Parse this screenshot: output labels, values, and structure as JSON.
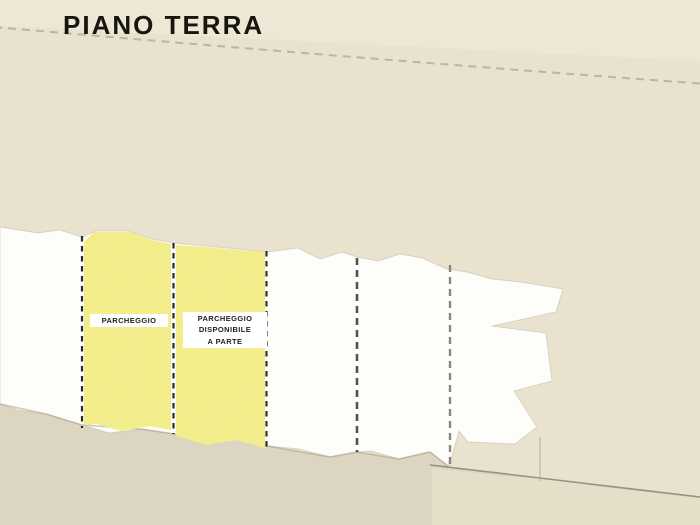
{
  "page": {
    "title": "PIANO TERRA"
  },
  "plan": {
    "floor_label": "PIANO TERRA",
    "spaces": [
      {
        "name": "space-1",
        "label": "",
        "highlighted": false
      },
      {
        "name": "space-2",
        "label": "PARCHEGGIO",
        "highlighted": true
      },
      {
        "name": "space-3",
        "label": "PARCHEGGIO\nDISPONIBILE\nA PARTE",
        "highlighted": true
      },
      {
        "name": "space-4",
        "label": "",
        "highlighted": false
      },
      {
        "name": "space-5",
        "label": "",
        "highlighted": false
      },
      {
        "name": "space-6",
        "label": "",
        "highlighted": false
      }
    ]
  },
  "colors": {
    "background": "#e9e2cf",
    "background_upper": "#eee8d6",
    "background_band": "#dcd5c1",
    "background_lower": "#e5dec9",
    "paper_white": "#fdfdfa",
    "highlight_yellow": "#f0ea7f",
    "highlight_dot": "#faf6ad",
    "divider_black": "#2e2b26",
    "divider_dark_gray": "#55524b",
    "divider_light_gray": "#8a867e",
    "faint_line": "#8f8779",
    "title_text": "#18150f",
    "label_text": "#221f1a"
  }
}
